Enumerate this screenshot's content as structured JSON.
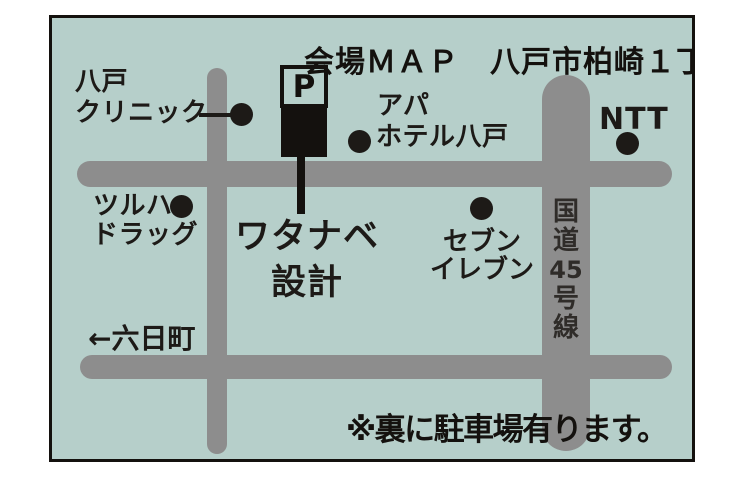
{
  "title": "会場ＭＡＰ　八戸市柏崎１丁目",
  "map": {
    "parking_sign": "P",
    "destination": {
      "line1": "ワタナベ",
      "line2": "設計"
    },
    "landmarks": {
      "clinic": {
        "line1": "八戸",
        "line2": "クリニック"
      },
      "apa_hotel": {
        "line1": "アパ",
        "line2": "ホテル八戸"
      },
      "ntt": {
        "label": "NTT"
      },
      "tsuruha": {
        "line1": "ツルハ",
        "line2": "ドラッグ"
      },
      "seven_eleven": {
        "line1": "セブン",
        "line2": "イレブン"
      }
    },
    "route45": {
      "chars": [
        "国",
        "道",
        "45",
        "号",
        "線"
      ]
    },
    "direction_west": "←六日町",
    "note": "※裏に駐車場有ります。"
  },
  "colors": {
    "map_background": "#b6cfca",
    "road": "#8d8d8d",
    "ink": "#14110e",
    "frame_border": "#14110e"
  }
}
